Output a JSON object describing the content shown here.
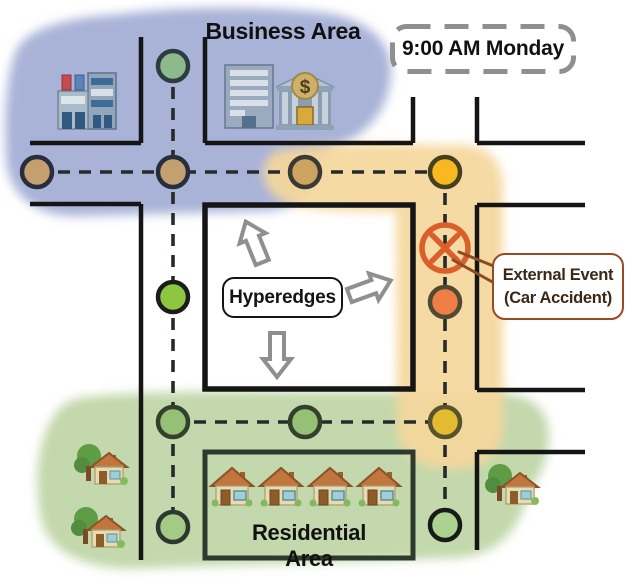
{
  "scene": {
    "time_badge": "9:00 AM Monday",
    "hyperedges_label": "Hyperedges",
    "external_event": {
      "line1": "External Event",
      "line2": "(Car Accident)"
    }
  },
  "areas": {
    "business": {
      "label": "Business Area",
      "color": "#a9b3d8",
      "icons": [
        "department-store",
        "office-building",
        "bank"
      ]
    },
    "event_zone": {
      "color": "#f5d79c"
    },
    "residential": {
      "label": "Residential Area",
      "color": "#c3d8ac",
      "icons": [
        "house",
        "house",
        "house",
        "house",
        "garden-house",
        "garden-house",
        "garden-house"
      ]
    }
  },
  "styles": {
    "road_color": "#151515",
    "residential_block_color": "#2d3a2d",
    "graph_edge_color": "#262b2a",
    "accident_color": "#db5f2b",
    "callout_pointer_color": "#8a4a22",
    "arrow_color": "#8f8f8f",
    "badge_border_color": "#8f8f8f",
    "external_event_border": "#9a4a22",
    "external_event_text": "#3b2817"
  },
  "graph": {
    "node_radius": 15,
    "edges": [
      {
        "id": "business-row",
        "x1": 37,
        "y1": 172,
        "x2": 445,
        "y2": 172
      },
      {
        "id": "west-column",
        "x1": 173,
        "y1": 66,
        "x2": 173,
        "y2": 527
      },
      {
        "id": "east-column",
        "x1": 445,
        "y1": 172,
        "x2": 445,
        "y2": 525
      },
      {
        "id": "residential-row",
        "x1": 173,
        "y1": 422,
        "x2": 445,
        "y2": 422
      }
    ],
    "nodes": [
      {
        "id": "business-north",
        "x": 173,
        "y": 66,
        "fill": "#8cba8e",
        "ring": "#2e3c40"
      },
      {
        "id": "business-west",
        "x": 37,
        "y": 172,
        "fill": "#c3a06d",
        "ring": "#272e3d"
      },
      {
        "id": "business-center",
        "x": 173,
        "y": 172,
        "fill": "#c3a06d",
        "ring": "#272e3d"
      },
      {
        "id": "business-east",
        "x": 305,
        "y": 172,
        "fill": "#cda45f",
        "ring": "#3a3a35"
      },
      {
        "id": "event-north",
        "x": 445,
        "y": 172,
        "fill": "#f7b821",
        "ring": "#45401f"
      },
      {
        "id": "mid-west",
        "x": 173,
        "y": 297,
        "fill": "#8dc63f",
        "ring": "#1c1c1c"
      },
      {
        "id": "event-south",
        "x": 445,
        "y": 302,
        "fill": "#ef7e46",
        "ring": "#4e4a33"
      },
      {
        "id": "residential-west",
        "x": 173,
        "y": 422,
        "fill": "#97c077",
        "ring": "#33402c"
      },
      {
        "id": "residential-center",
        "x": 305,
        "y": 422,
        "fill": "#97c077",
        "ring": "#33402c"
      },
      {
        "id": "residential-east",
        "x": 445,
        "y": 422,
        "fill": "#e3bb31",
        "ring": "#56532f"
      },
      {
        "id": "residential-southwest",
        "x": 173,
        "y": 527,
        "fill": "#a4cb86",
        "ring": "#2c3830"
      },
      {
        "id": "residential-southeast",
        "x": 445,
        "y": 525,
        "fill": "#abd28e",
        "ring": "#17191b"
      }
    ]
  }
}
